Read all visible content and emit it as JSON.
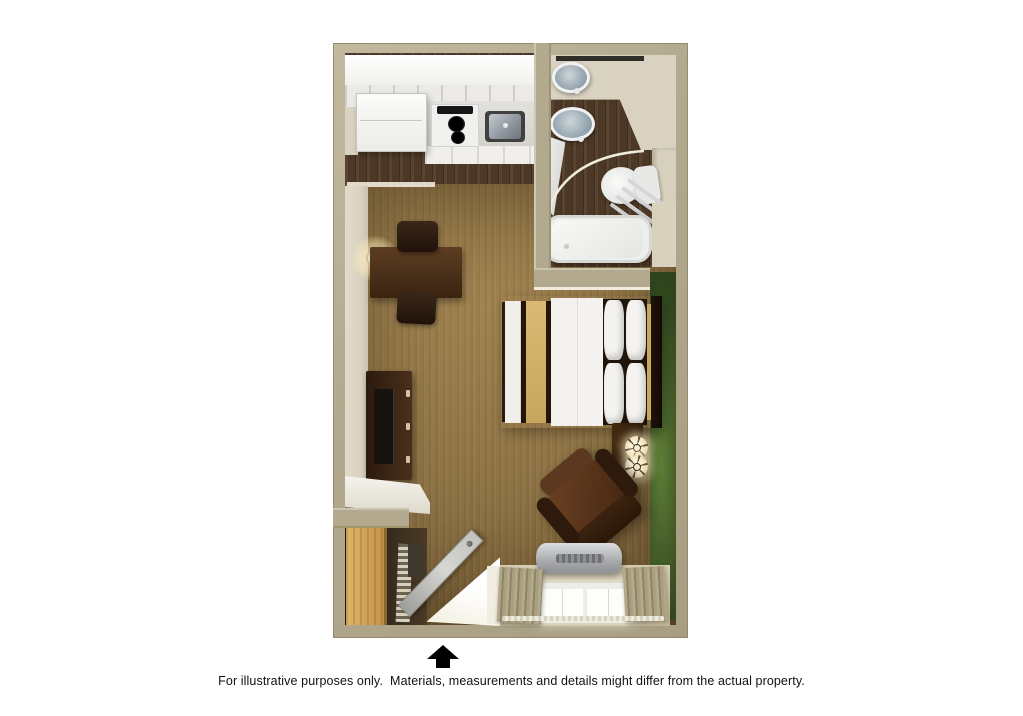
{
  "caption": {
    "text": "For illustrative purposes only.  Materials, measurements and details might differ from the actual property."
  },
  "entrance": {
    "icon": "up-arrow-icon",
    "meaning": "entrance direction marker"
  },
  "floor_plan": {
    "type": "studio-suite-top-down-floorplan",
    "rooms": [
      "kitchen",
      "bathroom",
      "living-sleeping-area",
      "closet"
    ],
    "fixtures": [
      "refrigerator",
      "stove-cooktop",
      "kitchen-sink",
      "upper-cabinets",
      "kitchen-counter",
      "bathroom-sink",
      "bathroom-sink",
      "vanity-mirror",
      "toilet",
      "towel-rack",
      "shower-curtain",
      "bathtub",
      "wall-lamp",
      "desk-table",
      "desk-chair",
      "desk-chair",
      "tv-dresser",
      "television",
      "bed",
      "pillows",
      "headboard",
      "bed-runner",
      "nightstand",
      "table-lamp",
      "table-lamp",
      "armchair",
      "ptac-air-conditioner",
      "window",
      "curtains",
      "entry-door",
      "closet-door",
      "ironing-rack",
      "luggage-item",
      "counter-shelf"
    ]
  },
  "colors": {
    "background": "#ffffff",
    "wall": "#b3a98e",
    "wall_face": "#d9d2c0",
    "wood_floor": "#4c3826",
    "carpet": "#8d7244",
    "accent_wall": "#46602a",
    "furniture_dark": "#3a2411",
    "armchair": "#472813",
    "runner_gold": "#d9ba74",
    "closet_wood": "#e0b468",
    "door_gray": "#d6d6d2",
    "ac_silver": "#a7a8aa",
    "curtain_tan": "#b3a88a",
    "text": "#111111"
  }
}
